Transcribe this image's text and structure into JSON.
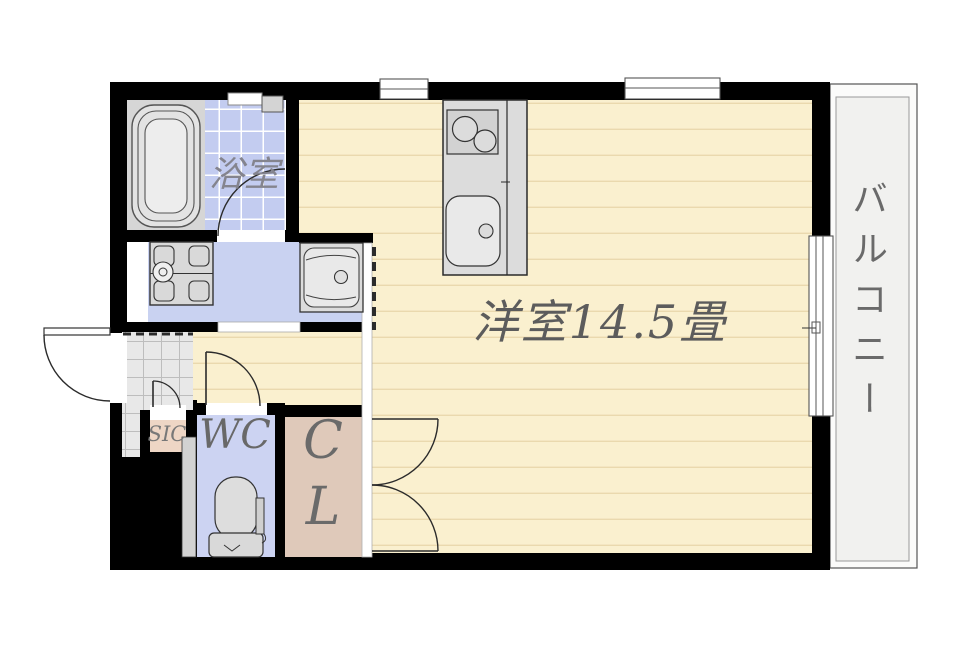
{
  "floorplan": {
    "rooms": {
      "main_room": {
        "label": "洋室14.5畳"
      },
      "bathroom": {
        "label": "浴室"
      },
      "toilet": {
        "label": "WC"
      },
      "closet": {
        "lines": [
          "C",
          "L"
        ]
      },
      "shoe_closet": {
        "label": "SIC"
      },
      "balcony": {
        "label": "バルコニー"
      }
    },
    "colors": {
      "wall": "#000000",
      "main_floor": "#faf0cf",
      "floor_line": "#ead9ae",
      "washroom_floor": "#c9d2f1",
      "bath_tile": "#c3ccf0",
      "wc_floor": "#ccd3f2",
      "closet_floor": "#dfc9ba",
      "shoe_closet_floor": "#eed6c5",
      "entry_tile": "#e8e8e8",
      "balcony_floor": "#f1f1ef",
      "fixture": "#dcdcdc",
      "label_text": "#666666"
    }
  }
}
